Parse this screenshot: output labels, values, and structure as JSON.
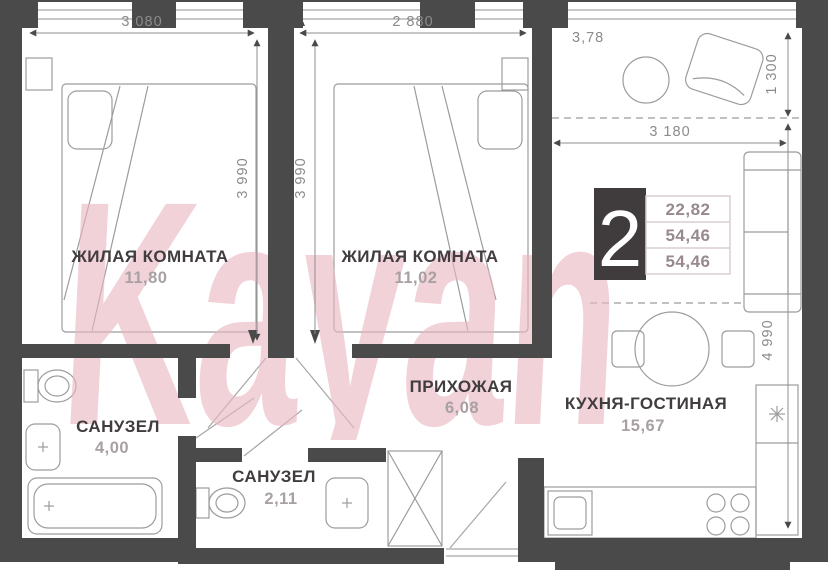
{
  "watermark": "Kayan",
  "badge": {
    "room_count": "2",
    "values": [
      "22,82",
      "54,46",
      "54,46"
    ]
  },
  "rooms": {
    "bedroom1": {
      "name": "ЖИЛАЯ КОМНАТА",
      "area": "11,80"
    },
    "bedroom2": {
      "name": "ЖИЛАЯ КОМНАТА",
      "area": "11,02"
    },
    "hallway": {
      "name": "ПРИХОЖАЯ",
      "area": "6,08"
    },
    "kitchen_living": {
      "name": "КУХНЯ-ГОСТИНАЯ",
      "area": "15,67"
    },
    "bathroom1": {
      "name": "САНУЗЕЛ",
      "area": "4,00"
    },
    "bathroom2": {
      "name": "САНУЗЕЛ",
      "area": "2,11"
    },
    "loggia": {
      "area": "3,78"
    }
  },
  "dimensions": {
    "bedroom1_width": "3 080",
    "bedroom2_width": "2 880",
    "bedroom1_depth": "3 990",
    "bedroom2_depth": "3 990",
    "loggia_depth": "1 300",
    "kitchen_width": "3 180",
    "kitchen_depth": "4 990"
  },
  "colors": {
    "wall": "#4a4a4a",
    "watermark_pink": "#eab6c2",
    "badge_bg": "#403c3e",
    "dim_text": "#8b8b8b",
    "room_label": "#413d3f",
    "area_label": "#a8a0a3",
    "furniture_line": "#9c9c9c"
  }
}
